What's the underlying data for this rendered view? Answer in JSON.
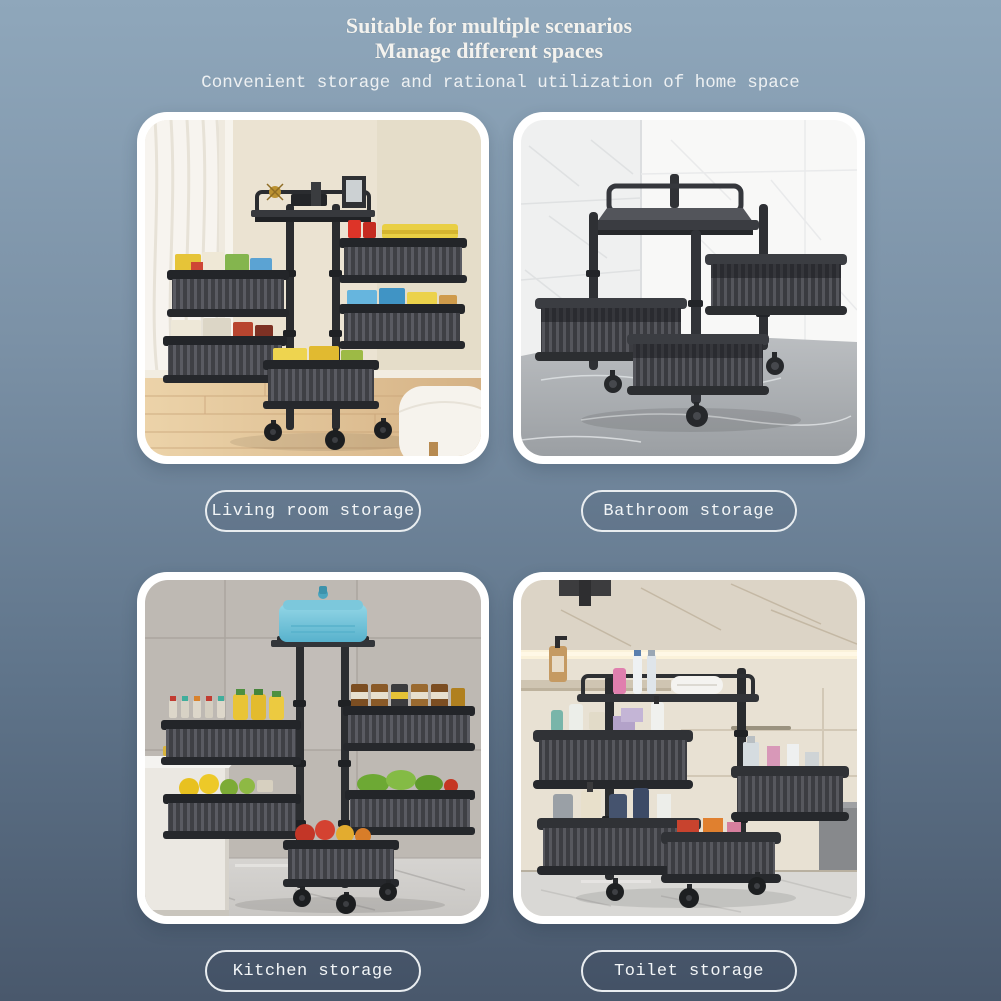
{
  "header": {
    "title_line1": "Suitable for multiple scenarios",
    "title_line2": "Manage different spaces",
    "subtitle": "Convenient storage and rational utilization of home space"
  },
  "cards": [
    {
      "label": "Living room storage"
    },
    {
      "label": "Bathroom storage"
    },
    {
      "label": "Kitchen storage"
    },
    {
      "label": "Toilet storage"
    }
  ],
  "colors": {
    "bg-top": "#8fa7bb",
    "bg-bottom": "#49586c",
    "heading-text": "#f3f2ee",
    "subtitle-text": "#edf0f2",
    "pill-border": "#e9edf0",
    "pill-text": "#f2f5f7",
    "card-frame": "#ffffff"
  }
}
